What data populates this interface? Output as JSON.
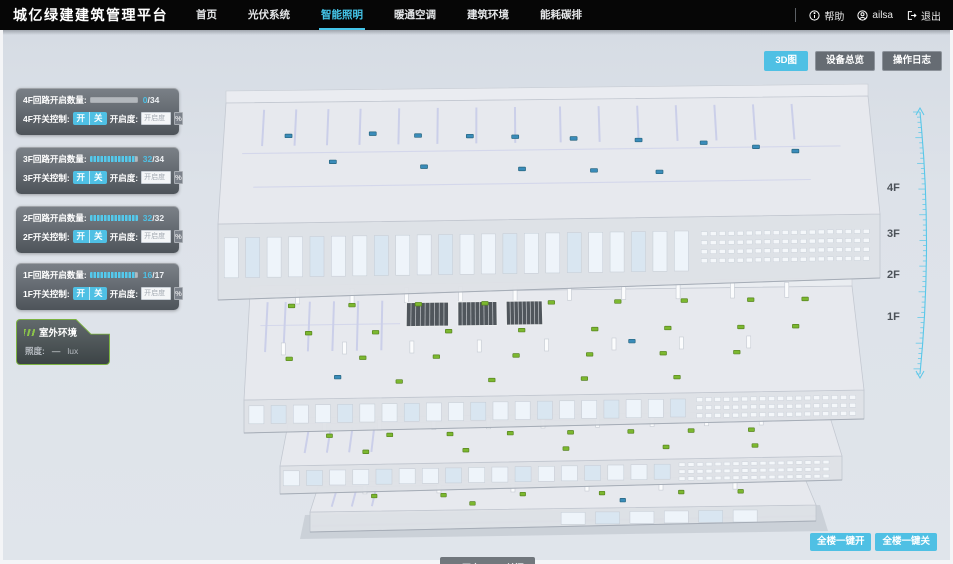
{
  "app": {
    "title": "城亿绿建建筑管理平台"
  },
  "nav": {
    "items": [
      {
        "label": "首页",
        "active": false
      },
      {
        "label": "光伏系统",
        "active": false
      },
      {
        "label": "智能照明",
        "active": true
      },
      {
        "label": "暖通空调",
        "active": false
      },
      {
        "label": "建筑环境",
        "active": false
      },
      {
        "label": "能耗碳排",
        "active": false
      }
    ]
  },
  "user": {
    "help_label": "帮助",
    "name": "ailsa",
    "logout_label": "退出"
  },
  "view_buttons": [
    {
      "label": "3D图",
      "active": true
    },
    {
      "label": "设备总览",
      "active": false
    },
    {
      "label": "操作日志",
      "active": false
    }
  ],
  "floor_panels": [
    {
      "floor": "4F",
      "circuit_label": "4F回路开启数量:",
      "count": "0",
      "total": "34",
      "progress": 0,
      "switch_label": "4F开关控制:",
      "on_label": "开",
      "off_label": "关",
      "dim_label": "开启度:",
      "dim_placeholder": "开启度",
      "percent_label": "%"
    },
    {
      "floor": "3F",
      "circuit_label": "3F回路开启数量:",
      "count": "32",
      "total": "34",
      "progress": 0.94,
      "switch_label": "3F开关控制:",
      "on_label": "开",
      "off_label": "关",
      "dim_label": "开启度:",
      "dim_placeholder": "开启度",
      "percent_label": "%"
    },
    {
      "floor": "2F",
      "circuit_label": "2F回路开启数量:",
      "count": "32",
      "total": "32",
      "progress": 1,
      "switch_label": "2F开关控制:",
      "on_label": "开",
      "off_label": "关",
      "dim_label": "开启度:",
      "dim_placeholder": "开启度",
      "percent_label": "%"
    },
    {
      "floor": "1F",
      "circuit_label": "1F回路开启数量:",
      "count": "16",
      "total": "17",
      "progress": 0.94,
      "switch_label": "1F开关控制:",
      "on_label": "开",
      "off_label": "关",
      "dim_label": "开启度:",
      "dim_placeholder": "开启度",
      "percent_label": "%"
    }
  ],
  "outdoor": {
    "title": "室外环境",
    "metric_label": "照度:",
    "value": "—",
    "unit": "lux"
  },
  "floor_scale": [
    "4F",
    "3F",
    "2F",
    "1F"
  ],
  "legend": {
    "on_label": "开启",
    "off_label": "关闭"
  },
  "bulk_buttons": [
    {
      "label": "全楼一键开"
    },
    {
      "label": "全楼一键关"
    }
  ],
  "colors": {
    "accent": "#4fc0e4",
    "nav_active": "#45c6ea",
    "marker_on": "#7cb82f",
    "marker_off": "#3a8cba",
    "ruler": "#58c7e9"
  },
  "building": {
    "floors": [
      {
        "name": "4F",
        "markers_on": [],
        "markers_off": [
          [
            0.1,
            0.28
          ],
          [
            0.17,
            0.5
          ],
          [
            0.23,
            0.27
          ],
          [
            0.3,
            0.29
          ],
          [
            0.31,
            0.55
          ],
          [
            0.38,
            0.3
          ],
          [
            0.45,
            0.31
          ],
          [
            0.46,
            0.58
          ],
          [
            0.54,
            0.33
          ],
          [
            0.57,
            0.6
          ],
          [
            0.64,
            0.35
          ],
          [
            0.67,
            0.62
          ],
          [
            0.74,
            0.38
          ],
          [
            0.82,
            0.42
          ],
          [
            0.88,
            0.46
          ]
        ]
      },
      {
        "name": "3F",
        "markers_on": [
          [
            0.07,
            0.12
          ],
          [
            0.17,
            0.12
          ],
          [
            0.28,
            0.12
          ],
          [
            0.39,
            0.12
          ],
          [
            0.5,
            0.12
          ],
          [
            0.61,
            0.12
          ],
          [
            0.72,
            0.12
          ],
          [
            0.83,
            0.12
          ],
          [
            0.92,
            0.12
          ],
          [
            0.1,
            0.38
          ],
          [
            0.21,
            0.38
          ],
          [
            0.33,
            0.38
          ],
          [
            0.45,
            0.38
          ],
          [
            0.57,
            0.38
          ],
          [
            0.69,
            0.38
          ],
          [
            0.81,
            0.38
          ],
          [
            0.9,
            0.38
          ],
          [
            0.07,
            0.62
          ],
          [
            0.19,
            0.62
          ],
          [
            0.31,
            0.62
          ],
          [
            0.44,
            0.62
          ],
          [
            0.56,
            0.62
          ],
          [
            0.68,
            0.62
          ],
          [
            0.8,
            0.62
          ],
          [
            0.25,
            0.85
          ],
          [
            0.4,
            0.85
          ],
          [
            0.55,
            0.85
          ],
          [
            0.7,
            0.85
          ]
        ],
        "markers_off": [
          [
            0.63,
            0.5
          ],
          [
            0.15,
            0.8
          ]
        ]
      },
      {
        "name": "2F",
        "markers_on": [
          [
            0.08,
            0.3
          ],
          [
            0.19,
            0.3
          ],
          [
            0.3,
            0.3
          ],
          [
            0.41,
            0.3
          ],
          [
            0.52,
            0.3
          ],
          [
            0.63,
            0.3
          ],
          [
            0.74,
            0.3
          ],
          [
            0.85,
            0.3
          ],
          [
            0.15,
            0.7
          ],
          [
            0.33,
            0.7
          ],
          [
            0.51,
            0.7
          ],
          [
            0.69,
            0.7
          ],
          [
            0.85,
            0.7
          ]
        ],
        "markers_off": []
      },
      {
        "name": "1F",
        "markers_on": [
          [
            0.12,
            0.4
          ],
          [
            0.26,
            0.4
          ],
          [
            0.42,
            0.4
          ],
          [
            0.58,
            0.4
          ],
          [
            0.74,
            0.4
          ],
          [
            0.86,
            0.4
          ],
          [
            0.32,
            0.75
          ]
        ],
        "markers_off": [
          [
            0.62,
            0.7
          ]
        ]
      }
    ]
  }
}
